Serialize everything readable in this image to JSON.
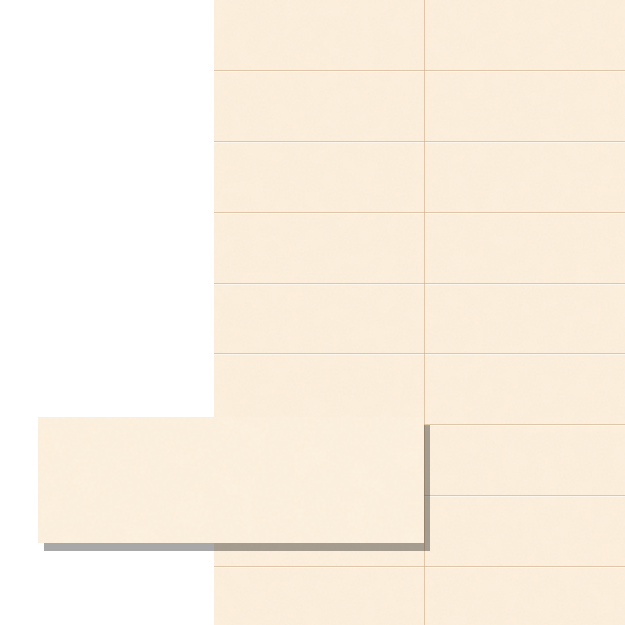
{
  "scene": {
    "type": "tile-product-preview",
    "background_color": "#ffffff",
    "wall": {
      "left": 214,
      "top": 0,
      "width": 411,
      "height": 625,
      "columns_visible": 2,
      "rows_visible": 9,
      "tile_width": 211,
      "tile_height": 70.875,
      "row_line_count": 8,
      "row_spacing": 70.875,
      "vertical_grout_offset": 210,
      "tile_base_color": "#fdf0de",
      "tile_speckle_color": "#edcfa8",
      "grout_dark_color": "rgba(196,159,118,0.50)",
      "grout_light_color": "rgba(255,253,249,0.55)"
    },
    "sample": {
      "left": 38,
      "top": 417,
      "width": 386,
      "height": 126,
      "base_color": "#fdf1e0",
      "speckle_color": "#eed0aa",
      "shadow_color": "rgba(0,0,0,0.34)",
      "shadow_dx": 6,
      "shadow_dy": 8
    }
  }
}
